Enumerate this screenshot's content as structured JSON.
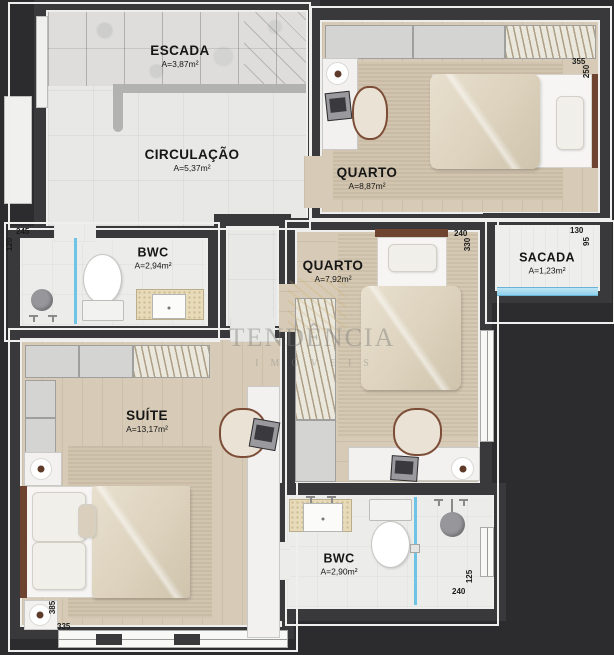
{
  "watermark": {
    "line1": "TENDÊNCIA",
    "line2": "IMÓVEIS"
  },
  "rooms": {
    "escada": {
      "name": "ESCADA",
      "area": "A=3,87m²"
    },
    "circulacao": {
      "name": "CIRCULAÇÃO",
      "area": "A=5,37m²"
    },
    "bwc_top": {
      "name": "BWC",
      "area": "A=2,94m²",
      "dim_w": "245",
      "dim_h": "120"
    },
    "quarto_top": {
      "name": "QUARTO",
      "area": "A=8,87m²",
      "dim_w": "355",
      "dim_h": "250"
    },
    "quarto_mid": {
      "name": "QUARTO",
      "area": "A=7,92m²",
      "dim_w": "240",
      "dim_h": "330"
    },
    "sacada": {
      "name": "SACADA",
      "area": "A=1,23m²",
      "dim_w": "130",
      "dim_h": "95"
    },
    "suite": {
      "name": "SUÍTE",
      "area": "A=13,17m²",
      "dim_w": "335",
      "dim_h": "385"
    },
    "bwc_bottom": {
      "name": "BWC",
      "area": "A=2,90m²",
      "dim_w": "240",
      "dim_h": "125"
    }
  },
  "colors": {
    "background": "#2c2c2e",
    "wall": "#39393b",
    "wood_floor": "#d7cbb7",
    "tile_floor": "#e8e8e6",
    "glass": "#8fd0ea",
    "counter": "#e7dbba",
    "wood_trim": "#6e4430"
  }
}
